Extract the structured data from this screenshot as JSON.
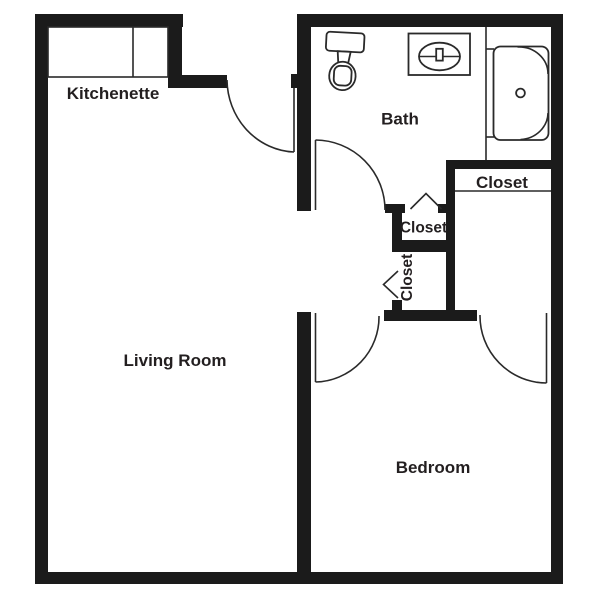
{
  "plan": {
    "type": "apartment-floor-plan",
    "rooms": {
      "kitchenette": {
        "label": "Kitchenette"
      },
      "bath": {
        "label": "Bath"
      },
      "living_room": {
        "label": "Living Room"
      },
      "bedroom": {
        "label": "Bedroom"
      },
      "closet_right": {
        "label": "Closet"
      },
      "closet_upper": {
        "label": "Closet"
      },
      "closet_lower": {
        "label": "Closet"
      }
    },
    "fixtures": [
      "toilet",
      "sink",
      "bathtub-shower",
      "kitchenette-counter"
    ],
    "doors": [
      "entry-door",
      "bath-door",
      "bedroom-door",
      "closet-door-bedroom",
      "closet-door-upper",
      "closet-door-lower"
    ],
    "colors": {
      "wall": "#1b1b1b",
      "line": "#2a2a2a",
      "text": "#231f20",
      "background": "#ffffff"
    }
  }
}
